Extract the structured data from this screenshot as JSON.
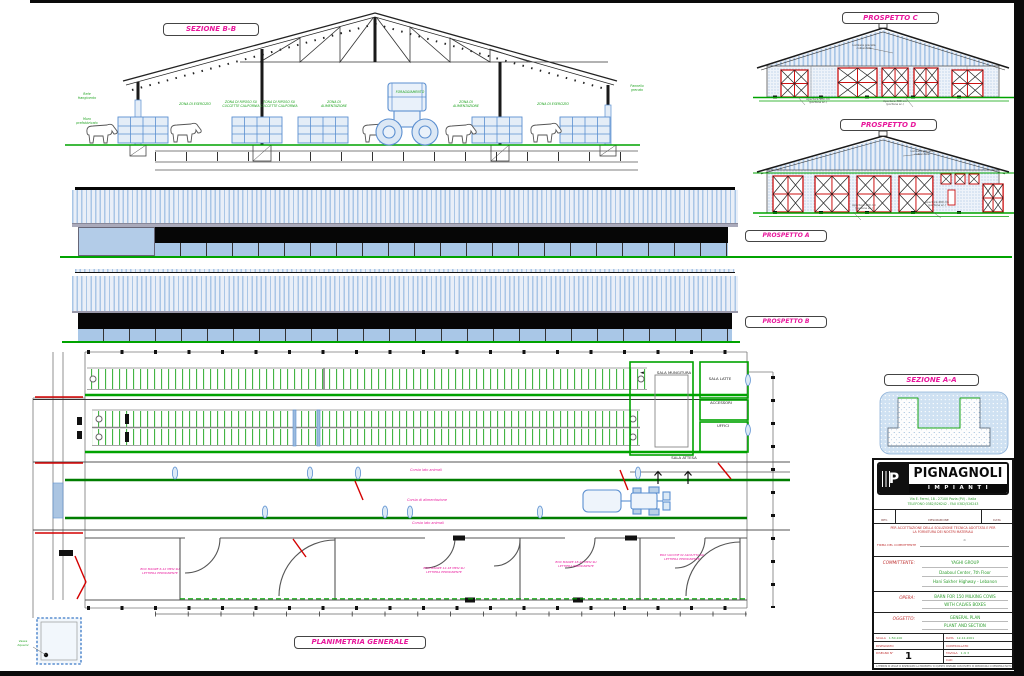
{
  "colors": {
    "pink": "#e8189c",
    "green": "#00a300",
    "blue": "#5b8fd0",
    "red": "#d40000",
    "title_green": "#2f9e2f",
    "title_red": "#c03333"
  },
  "icons": {
    "arrow_left": "◄",
    "arrow_up": "↑"
  },
  "views": {
    "sezione_bb": "SEZIONE B-B",
    "prospetto_c": "PROSPETTO C",
    "prospetto_d": "PROSPETTO D",
    "prospetto_a": "PROSPETTO A",
    "prospetto_b": "PROSPETTO B",
    "sezione_aa": "SEZIONE A-A",
    "planimetria": "PLANIMETRIA GENERALE"
  },
  "section_bb_notes": {
    "left_top": "Rete\nfrangivento",
    "left_bottom": "Muro\nprefabbricato",
    "zona_esercizio": "ZONA DI ESERCIZIO",
    "zona_riposo_1": "ZONA DI RIPOSO SU\nCUCCETTE CALIFORNIA",
    "zona_riposo_2": "ZONA DI RIPOSO SU\nCUCCETTE CALIFORNIA",
    "zona_alimentazione_1": "ZONA DI\nALIMENTAZIONE",
    "foraggiamento": "FORAGGIAMENTO",
    "zona_alimentazione_2": "ZONA DI\nALIMENTAZIONE",
    "zona_esercizio_2": "ZONA DI ESERCIZIO",
    "right_note": "Pannello\ngrecato"
  },
  "elevation_notes": {
    "c_roof": "Lamiera grecata\ncoibentata",
    "c_door_left": "Apertura 400 cm\n(portone sc.)",
    "c_door_right": "Apertura 400 cm\n(portone sc.)",
    "d_roof": "Lamiera grecata\ncoibentata",
    "d_door_left": "Apertura 400 cm\n(portone sc.)",
    "d_door_right": "Apertura 400 cm\n(portone sc.)"
  },
  "plan": {
    "sala_mungitura": "SALA MUNGITURA",
    "sala_latte": "SALA LATTE",
    "accessori": "ACCESSORI",
    "uffici": "UFFICI",
    "sala_attesa": "SALA ATTESA",
    "corsia_top": "Corsia lato animali",
    "corsia_centrale": "Corsia di alimentazione",
    "corsia_bottom": "Corsia lato animali",
    "pens": [
      "BOX MANZE 6-12 MESI SU\nLETTIERA PERMANENTE",
      "BOX MANZE 12-18 MESI SU\nLETTIERA PERMANENTE",
      "BOX MANZE 18-24 MESI SU\nLETTIERA PERMANENTE",
      "BOX VACCHE IN ASCIUTTA SU\nLETTIERA PERMANENTE"
    ],
    "tank_note": "Vasca\nliquami"
  },
  "title_block": {
    "brand": "PIGNAGNOLI",
    "brand_sub": "IMPIANTI",
    "address_line_1": "Via E. Fermi, 18 - 27100 Pavia (PV) - Italia",
    "address_line_2": "TELEFONO 0382/526242 - FAX 0382/526243",
    "rev_col_1": "REV.",
    "rev_col_2": "DESCRIZIONE",
    "rev_col_3": "DATA",
    "disclaimer_line_1": "PER ACCETTAZIONE DELLA SOLUZIONE TECNICA ADOTTATA E PER",
    "disclaimer_line_2": "LA FORNITURA DEI NOSTRI MATERIALI",
    "firma_label": "FIRMA DEL COMMITTENTE",
    "signature_sep": "di",
    "committente_label": "COMMITTENTE:",
    "committente_1": "YAGHI GROUP",
    "committente_2": "Daaboul Center, 7th Floor",
    "committente_3": "Hani Sakher Highway - Lebanon",
    "opera_label": "OPERA:",
    "opera_1": "BARN FOR 150 MILKING COWS",
    "opera_2": "WITH CALVES BOXES",
    "oggetto_label": "OGGETTO:",
    "oggetto_1": "GENERAL PLAN",
    "oggetto_2": "PLANT AND SECTION",
    "scala_label": "SCALA",
    "scala_value": "1:50,100",
    "data_label": "DATA",
    "data_value": "12-12-2001",
    "disegnato_label": "DISEGNATO",
    "controllato_label": "CONTROLLATO",
    "disegno_label": "DISEGNO N°",
    "disegno_value": "1",
    "tavola_label": "TAVOLA",
    "tavola_value": "1 di 3",
    "cad_label": "CAD",
    "footer": "A TERMINI DI LEGGE CI RISERVIAMO LA PROPRIETA' DI QUESTO DISEGNO CON DIVIETO DI RIPRODURLO O RENDERLO NOTO A TERZI SENZA AUTORIZZAZIONE"
  }
}
